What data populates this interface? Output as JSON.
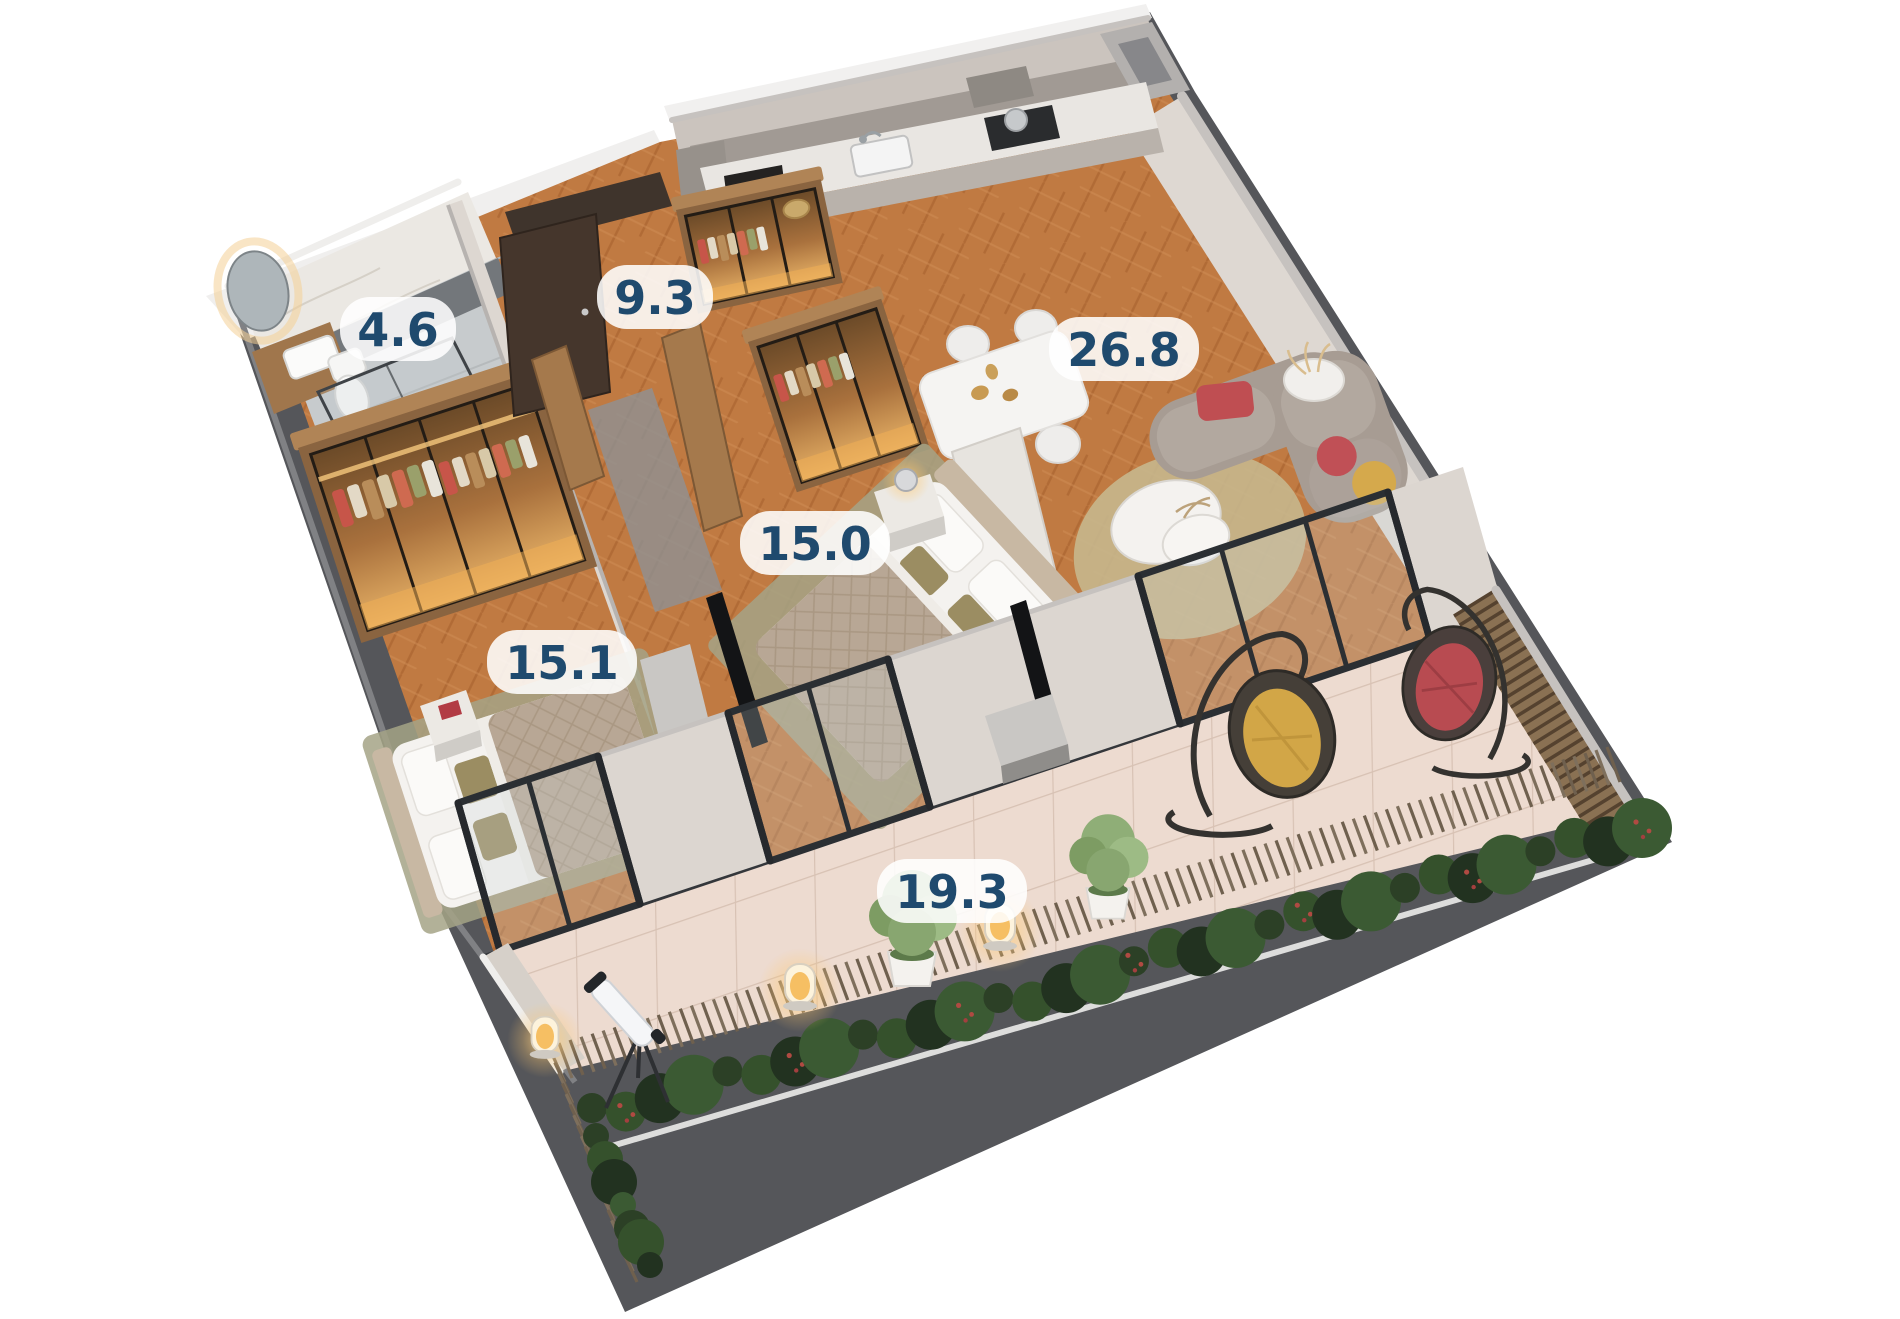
{
  "page": {
    "background": "#ffffff",
    "type": "3d-floor-plan-render"
  },
  "floor_plan": {
    "labels": [
      {
        "id": "bathroom",
        "area": "4.6"
      },
      {
        "id": "hallway",
        "area": "9.3"
      },
      {
        "id": "living-kitchen",
        "area": "26.8"
      },
      {
        "id": "bedroom-master",
        "area": "15.0"
      },
      {
        "id": "bedroom-second",
        "area": "15.1"
      },
      {
        "id": "terrace",
        "area": "19.3"
      }
    ],
    "label_style": {
      "text_color": "#1f4a6e",
      "pill_color": "#ffffff"
    },
    "palette": {
      "wood_floor": "#c07a42",
      "terrace_tile": "#eddbd0",
      "wall_light": "#dcd6d0",
      "wall_cap": "#c6c2bf",
      "base_slab": "#55565a",
      "hedge_green": "#35512c",
      "sofa_gray": "#a79c93",
      "accent_red": "#bf4e52",
      "accent_yellow": "#d5a94c",
      "wardrobe_glow": "#f0ae55"
    }
  }
}
